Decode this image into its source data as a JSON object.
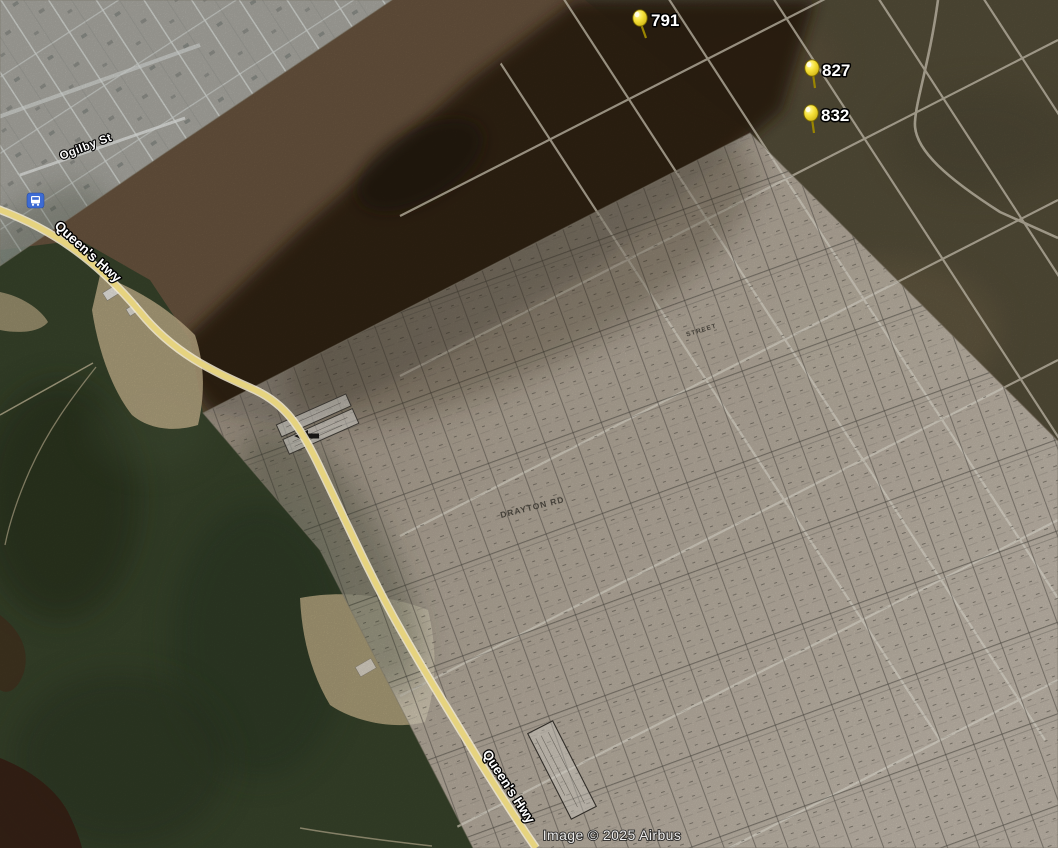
{
  "view": {
    "attribution": "Image © 2025 Airbus"
  },
  "placemarks": [
    {
      "label": "791"
    },
    {
      "label": "827"
    },
    {
      "label": "832"
    }
  ],
  "road_labels": {
    "queens_hwy_left": "Queen's Hwy",
    "queens_hwy_bottom": "Queen's Hwy",
    "ogilby_st": "Ogilby St"
  },
  "overlay_map_labels": {
    "drayton_rd": "DRAYTON RD",
    "street": "STREET"
  },
  "icons": {
    "bus_stop": "bus-stop-icon"
  },
  "colors": {
    "pushpin": "#f7e23b",
    "highway_vector": "#e6d37f",
    "label_text": "#ffffff",
    "label_outline": "#000000",
    "transit_icon": "#3d6bd3",
    "overlay_paper": "#e9e5da",
    "forest": "#39452c",
    "scrub": "#6b5640",
    "shadow_terrain": "#2b1d10"
  }
}
